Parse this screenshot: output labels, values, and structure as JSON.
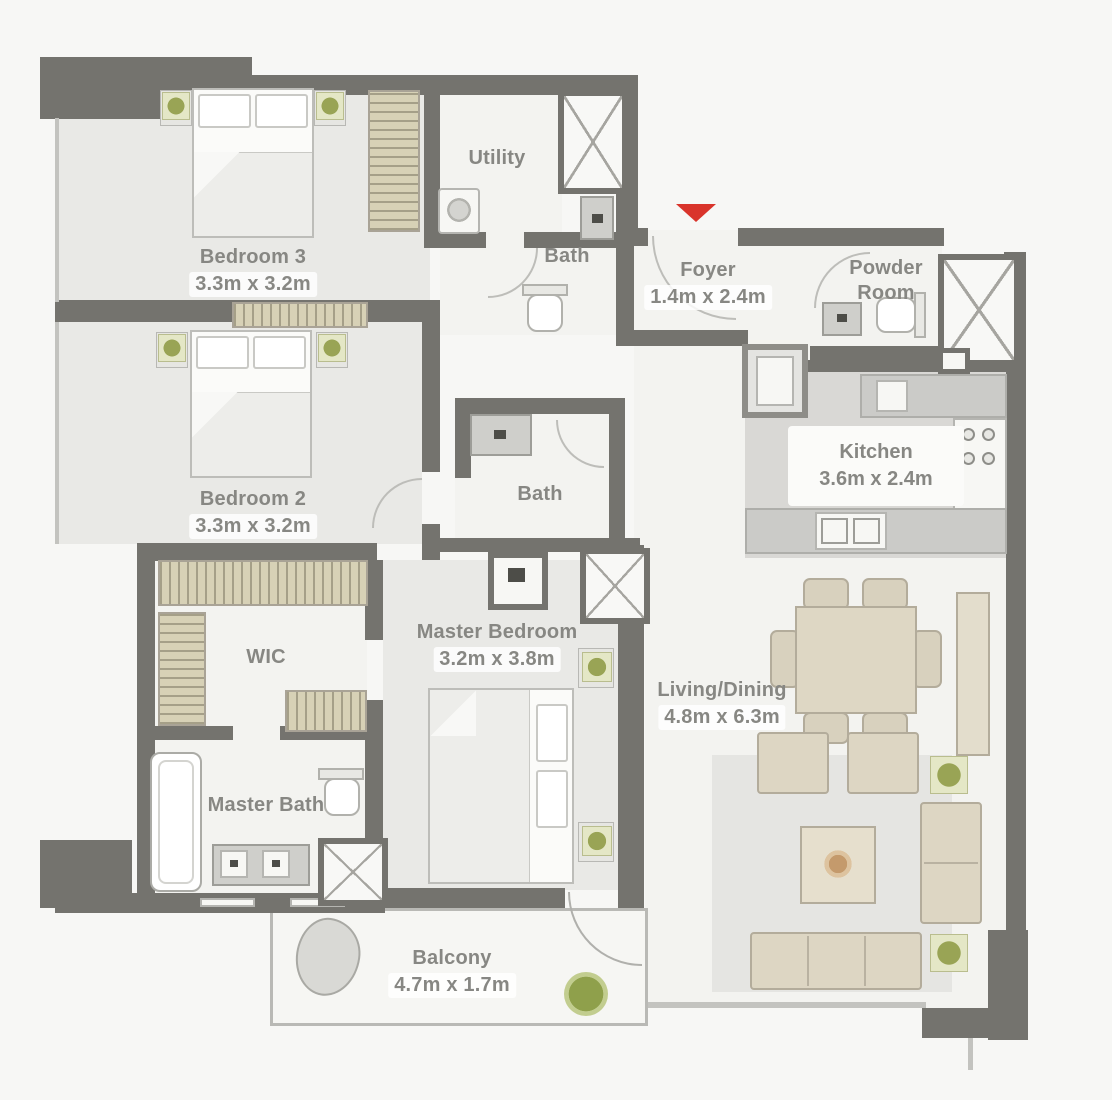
{
  "plan": {
    "title": "Apartment floor plan",
    "rooms": [
      {
        "id": "bedroom3",
        "name": "Bedroom 3",
        "dims": "3.3m x 3.2m"
      },
      {
        "id": "utility",
        "name": "Utility",
        "dims": ""
      },
      {
        "id": "bath-top",
        "name": "Bath",
        "dims": ""
      },
      {
        "id": "foyer",
        "name": "Foyer",
        "dims": "1.4m x 2.4m"
      },
      {
        "id": "powder-room",
        "name": "Powder Room",
        "dims": ""
      },
      {
        "id": "kitchen",
        "name": "Kitchen",
        "dims": "3.6m x 2.4m"
      },
      {
        "id": "bedroom2",
        "name": "Bedroom 2",
        "dims": "3.3m x 3.2m"
      },
      {
        "id": "bath-mid",
        "name": "Bath",
        "dims": ""
      },
      {
        "id": "wic",
        "name": "WIC",
        "dims": ""
      },
      {
        "id": "master-bedroom",
        "name": "Master Bedroom",
        "dims": "3.2m x 3.8m"
      },
      {
        "id": "living-dining",
        "name": "Living/Dining",
        "dims": "4.8m x 6.3m"
      },
      {
        "id": "master-bath",
        "name": "Master Bath",
        "dims": ""
      },
      {
        "id": "balcony",
        "name": "Balcony",
        "dims": "4.7m x 1.7m"
      }
    ],
    "colors": {
      "wall": "#74736e",
      "entrance_arrow": "#d9342b",
      "plant_green": "#99a455",
      "furniture_beige": "#ddd6c3",
      "wardrobe_tan": "#d7d1b6",
      "kitchen_floor": "#d9d8d5",
      "room_floor_gray": "#e9e9e6",
      "label_text": "#878783"
    }
  }
}
